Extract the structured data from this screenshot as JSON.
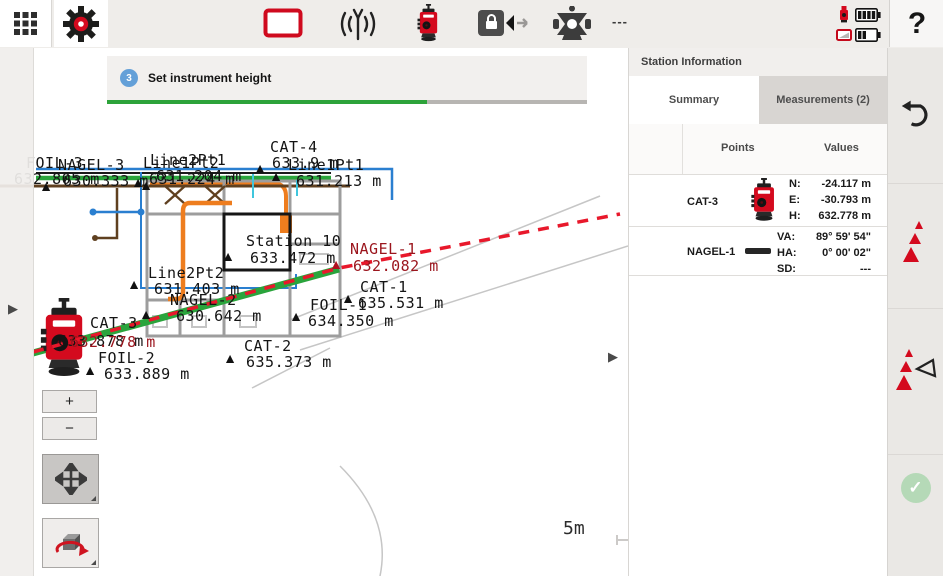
{
  "colors": {
    "accent_red": "#d40a1e",
    "map_green": "#2aa43c",
    "dash_red": "#e8182b",
    "map_label_red": "#9b151d",
    "orange": "#ee7d1e",
    "blue": "#2a7fd0",
    "progress_green": "#2da33a"
  },
  "toolbar": {
    "prism_status": "---",
    "help_label": "?"
  },
  "step": {
    "number": "3",
    "label": "Set instrument height",
    "progress_pct": 67
  },
  "map": {
    "scale_label": "5m",
    "zoom_in_label": "+",
    "zoom_out_label": "−",
    "points": [
      {
        "name": "FOIL-3",
        "elev": "632.805 m",
        "marker": false,
        "x": 20,
        "y": 136,
        "nx": 26,
        "ny": 108,
        "vx": 14,
        "vy": 124
      },
      {
        "name": "NAGEL-3",
        "elev": "630.333 m",
        "x": 46,
        "y": 134,
        "nx": 58,
        "ny": 110,
        "vx": 63,
        "vy": 126
      },
      {
        "name": "Line1Pt2",
        "elev": "631.224 m",
        "x": 146,
        "y": 133,
        "nx": 143,
        "ny": 108,
        "vx": 149,
        "vy": 124
      },
      {
        "name": "Line2Pt1",
        "elev": "631.204 m",
        "x": 138,
        "y": 130,
        "nx": 150,
        "ny": 105,
        "vx": 156,
        "vy": 121
      },
      {
        "name": "CAT-4",
        "elev": "633.9 m",
        "x": 260,
        "y": 116,
        "nx": 270,
        "ny": 92,
        "vx": 272,
        "vy": 108
      },
      {
        "name": "Line1Pt1",
        "elev": "631.213 m",
        "x": 276,
        "y": 124,
        "nx": 288,
        "ny": 110,
        "vx": 296,
        "vy": 126
      },
      {
        "name": "Station 10",
        "elev": "633.472 m",
        "x": 228,
        "y": 204,
        "nx": 246,
        "ny": 186,
        "vx": 250,
        "vy": 203
      },
      {
        "name": "NAGEL-1",
        "elev": "632.082 m",
        "red": true,
        "x": 336,
        "y": 212,
        "nx": 350,
        "ny": 194,
        "vx": 353,
        "vy": 211
      },
      {
        "name": "Line2Pt2",
        "elev": "631.403 m",
        "x": 134,
        "y": 232,
        "nx": 148,
        "ny": 218,
        "vx": 154,
        "vy": 234
      },
      {
        "name": "NAGEL-2",
        "elev": "630.642 m",
        "x": 146,
        "y": 262,
        "nx": 170,
        "ny": 245,
        "vx": 176,
        "vy": 261
      },
      {
        "name": "CAT-1",
        "elev": "635.531 m",
        "x": 348,
        "y": 246,
        "nx": 360,
        "ny": 232,
        "vx": 358,
        "vy": 248
      },
      {
        "name": "FOIL-1",
        "elev": "634.350 m",
        "x": 296,
        "y": 264,
        "nx": 310,
        "ny": 250,
        "vx": 308,
        "vy": 266
      },
      {
        "name": "CAT-2",
        "elev": "635.373 m",
        "x": 230,
        "y": 306,
        "nx": 244,
        "ny": 291,
        "vx": 246,
        "vy": 307
      },
      {
        "name": "CAT-3",
        "elev": "632.778 m",
        "marker": false,
        "red_value": true,
        "x": 60,
        "y": 300,
        "nx": 90,
        "ny": 268,
        "vx": 70,
        "vy": 287,
        "shadow_elev": "633.878 m",
        "sx": 58,
        "sy": 286
      },
      {
        "name": "FOIL-2",
        "elev": "633.889 m",
        "x": 90,
        "y": 318,
        "nx": 98,
        "ny": 303,
        "vx": 104,
        "vy": 319
      }
    ]
  },
  "panel": {
    "title": "Station Information",
    "tabs": [
      {
        "label": "Summary"
      },
      {
        "label": "Measurements (2)"
      }
    ],
    "columns": {
      "points": "Points",
      "values": "Values"
    },
    "rows": [
      {
        "point": "CAT-3",
        "icon": "total-station-icon",
        "lines": [
          {
            "k": "N:",
            "v": "-24.117 m"
          },
          {
            "k": "E:",
            "v": "-30.793 m"
          },
          {
            "k": "H:",
            "v": "632.778 m"
          }
        ]
      },
      {
        "point": "NAGEL-1",
        "icon": "level-staff-icon",
        "lines": [
          {
            "k": "VA:",
            "v": "89° 59' 54\""
          },
          {
            "k": "HA:",
            "v": "0° 00' 02\""
          },
          {
            "k": "SD:",
            "v": "---"
          }
        ]
      }
    ]
  }
}
